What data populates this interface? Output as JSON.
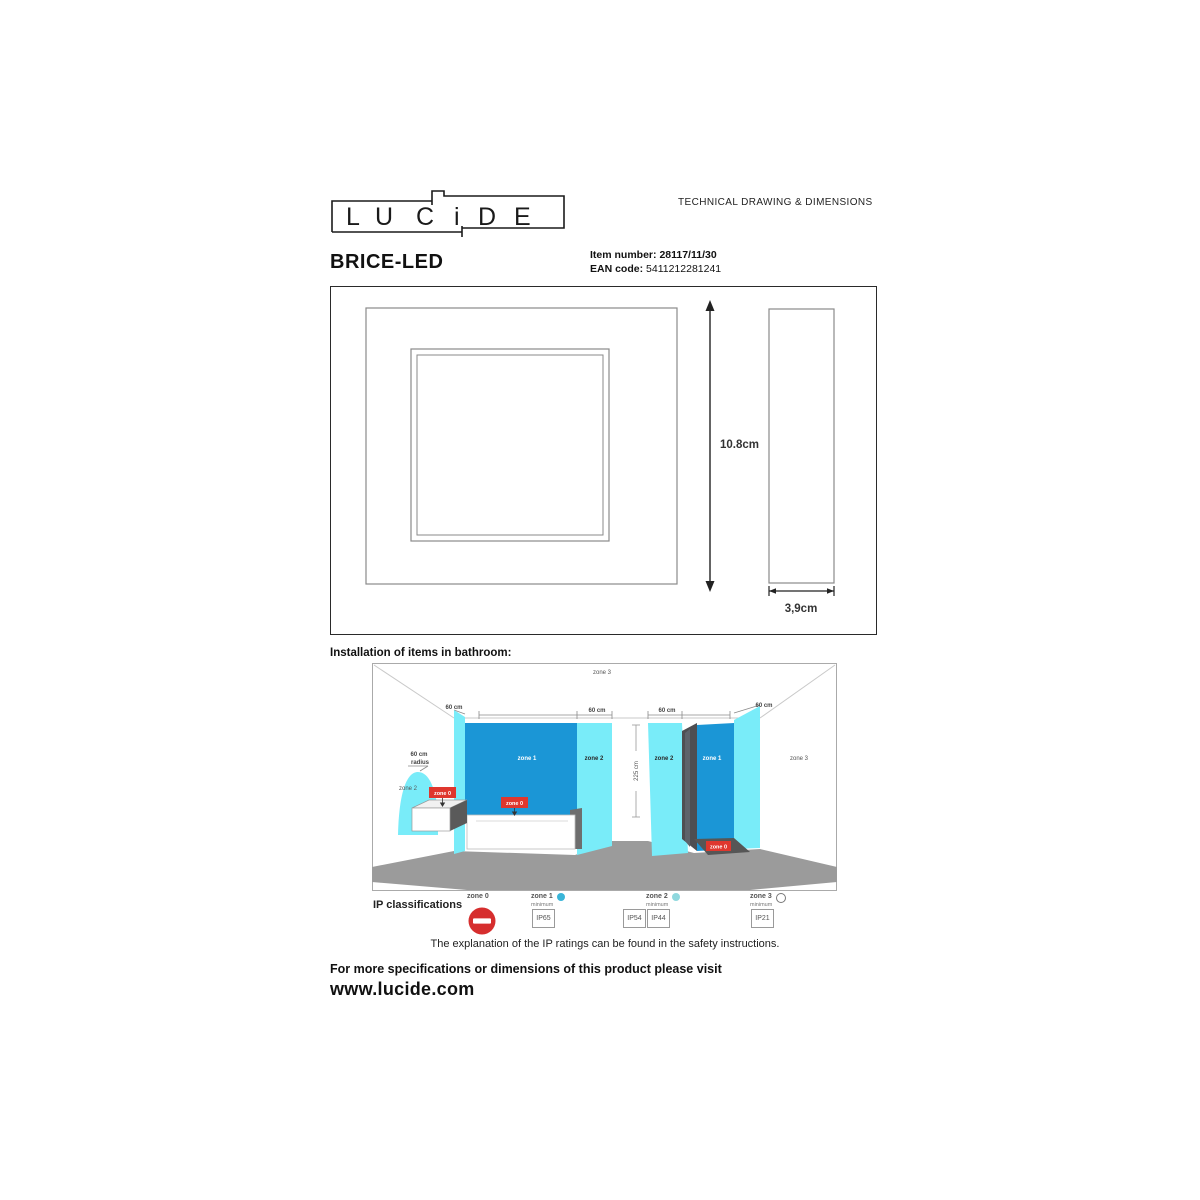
{
  "header": {
    "logo_letters": [
      "L",
      "U",
      "C",
      "i",
      "D",
      "E"
    ],
    "doc_title": "TECHNICAL DRAWING & DIMENSIONS",
    "product_name": "BRICE-LED",
    "item_number_label": "Item number:",
    "item_number_value": "28117/11/30",
    "ean_label": "EAN code:",
    "ean_value": "5411212281241"
  },
  "dimensions": {
    "height_label": "10.8cm",
    "depth_label": "3,9cm"
  },
  "bathroom": {
    "section_title": "Installation of items in bathroom:",
    "labels": {
      "zone0": "zone 0",
      "zone1": "zone 1",
      "zone2": "zone 2",
      "zone3": "zone 3",
      "dim_60cm": "60 cm",
      "radius_line1": "60 cm",
      "radius_line2": "radius",
      "dim_height": "225 cm"
    },
    "colors": {
      "zone1_blue": "#1b96d6",
      "zone2_cyan": "#79ecf9",
      "zone0_red": "#df372e",
      "floor_grey": "#9b9b9b",
      "panel_dark": "#4e4e52"
    }
  },
  "legend": {
    "title": "IP classifications",
    "items": [
      {
        "zone": "zone 0",
        "minimum": "",
        "ratings": []
      },
      {
        "zone": "zone 1",
        "minimum": "minimum",
        "ratings": [
          "IP65"
        ]
      },
      {
        "zone": "zone 2",
        "minimum": "minimum",
        "ratings": [
          "IP54",
          "IP44"
        ]
      },
      {
        "zone": "zone 3",
        "minimum": "minimum",
        "ratings": [
          "IP21"
        ]
      }
    ],
    "note": "The explanation of the IP ratings can be found in the safety instructions."
  },
  "footer": {
    "line1": "For more specifications or dimensions of this product please visit",
    "website": "www.lucide.com"
  }
}
